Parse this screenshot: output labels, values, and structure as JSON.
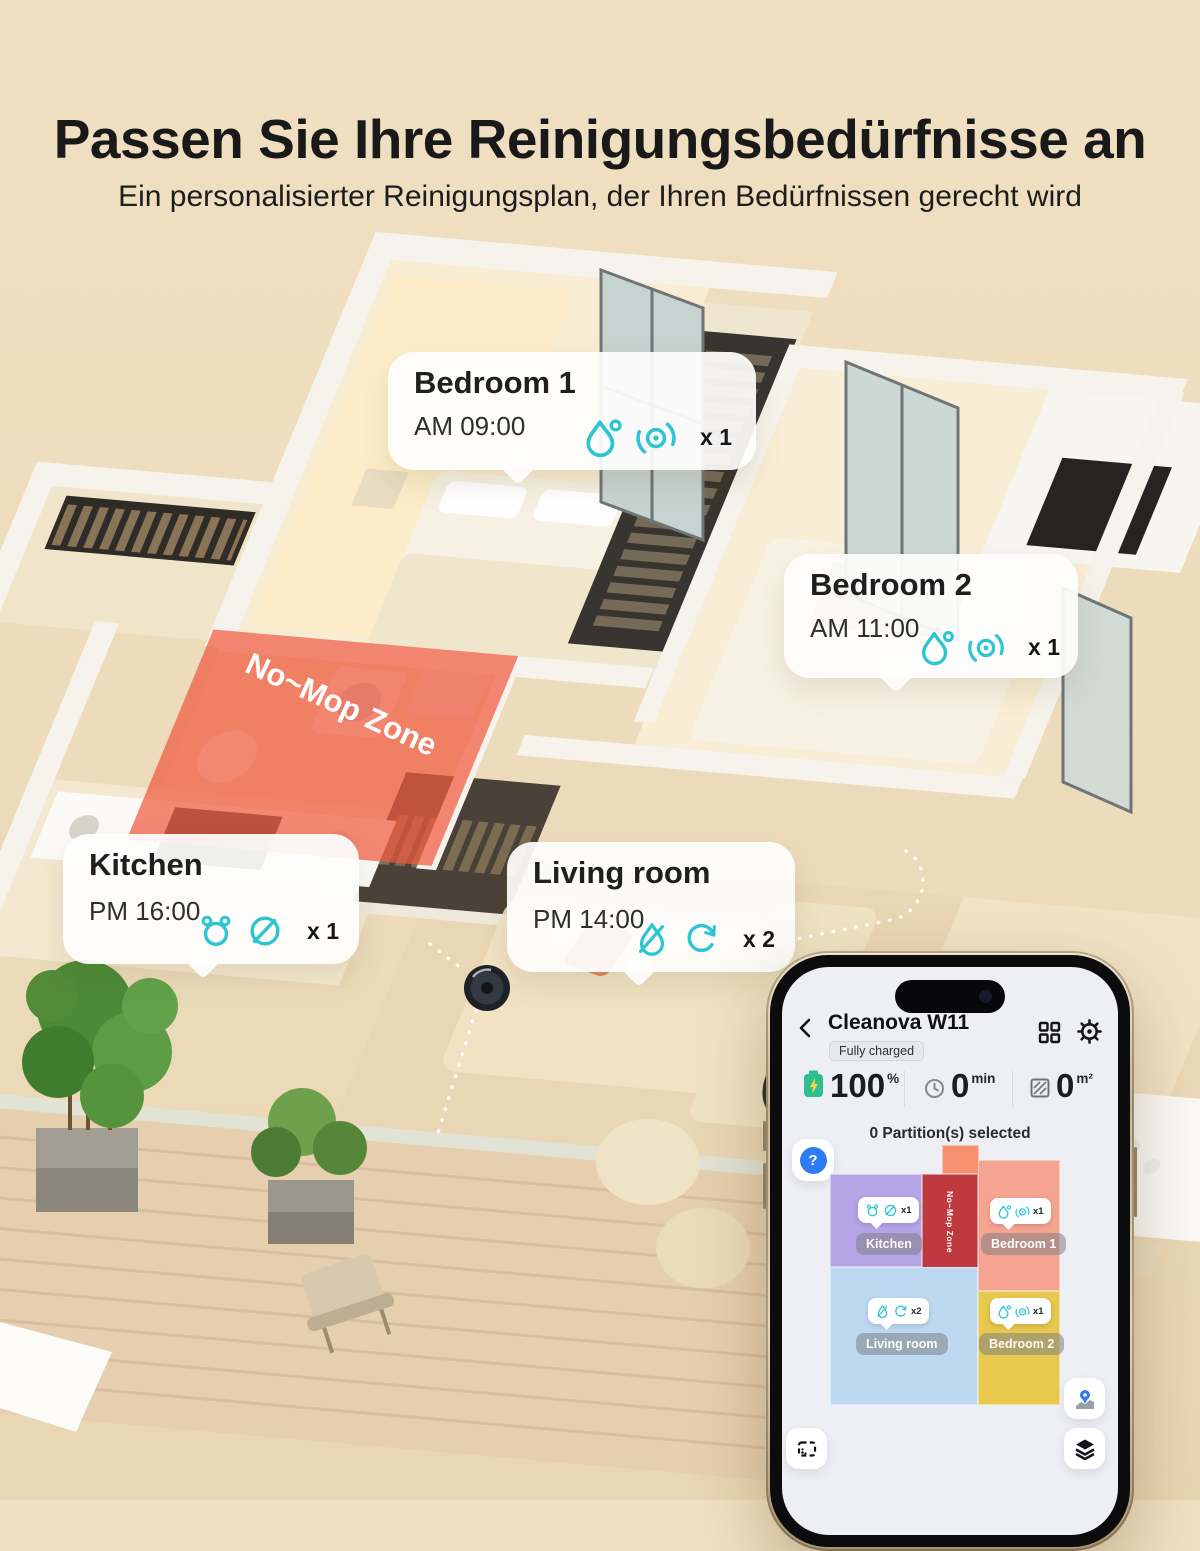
{
  "page": {
    "background": "#ecdbba"
  },
  "header": {
    "title": "Passen Sie Ihre Reinigungsbedürfnisse an",
    "subtitle": "Ein personalisierter Reinigungsplan, der Ihren Bedürfnissen gerecht wird"
  },
  "scene": {
    "no_mop_label": "No~Mop Zone",
    "callouts": [
      {
        "name": "Bedroom 1",
        "time": "AM 09:00",
        "count": "x 1",
        "icons": [
          "water-drop-icon",
          "mop-disc-icon"
        ]
      },
      {
        "name": "Bedroom 2",
        "time": "AM 11:00",
        "count": "x 1",
        "icons": [
          "water-drop-icon",
          "mop-disc-icon"
        ]
      },
      {
        "name": "Kitchen",
        "time": "PM 16:00",
        "count": "x 1",
        "icons": [
          "alarm-drops-icon",
          "no-mop-icon"
        ]
      },
      {
        "name": "Living room",
        "time": "PM 14:00",
        "count": "x 2",
        "icons": [
          "no-water-icon",
          "spin-icon"
        ]
      }
    ]
  },
  "phone": {
    "title": "Cleanova W11",
    "status_badge": "Fully charged",
    "stats": {
      "battery_value": "100",
      "battery_unit": "%",
      "runtime_value": "0",
      "runtime_unit": "min",
      "area_value": "0",
      "area_unit": "m²"
    },
    "selection_text": "0 Partition(s) selected",
    "help_glyph": "?",
    "map": {
      "no_mop_label": "No~Mop Zone",
      "rooms": [
        {
          "label": "Kitchen",
          "count": "x1",
          "color": "#b5a5e6",
          "icons": [
            "alarm-drops-icon",
            "no-mop-icon"
          ]
        },
        {
          "label": "Bedroom 1",
          "count": "x1",
          "color": "#f6a492",
          "icons": [
            "water-drop-icon",
            "mop-disc-icon"
          ]
        },
        {
          "label": "Living room",
          "count": "x2",
          "color": "#bdd9f2",
          "icons": [
            "no-water-icon",
            "spin-icon"
          ]
        },
        {
          "label": "Bedroom 2",
          "count": "x1",
          "color": "#e9c84e",
          "icons": [
            "water-drop-icon",
            "mop-disc-icon"
          ]
        }
      ]
    }
  },
  "colors": {
    "accent_teal": "#2ec5d3",
    "no_mop_overlay": "#ef5a3e",
    "map_no_mop_red": "#bf3a3e",
    "battery_green": "#2fbf8f",
    "help_blue": "#2e7bf6"
  }
}
